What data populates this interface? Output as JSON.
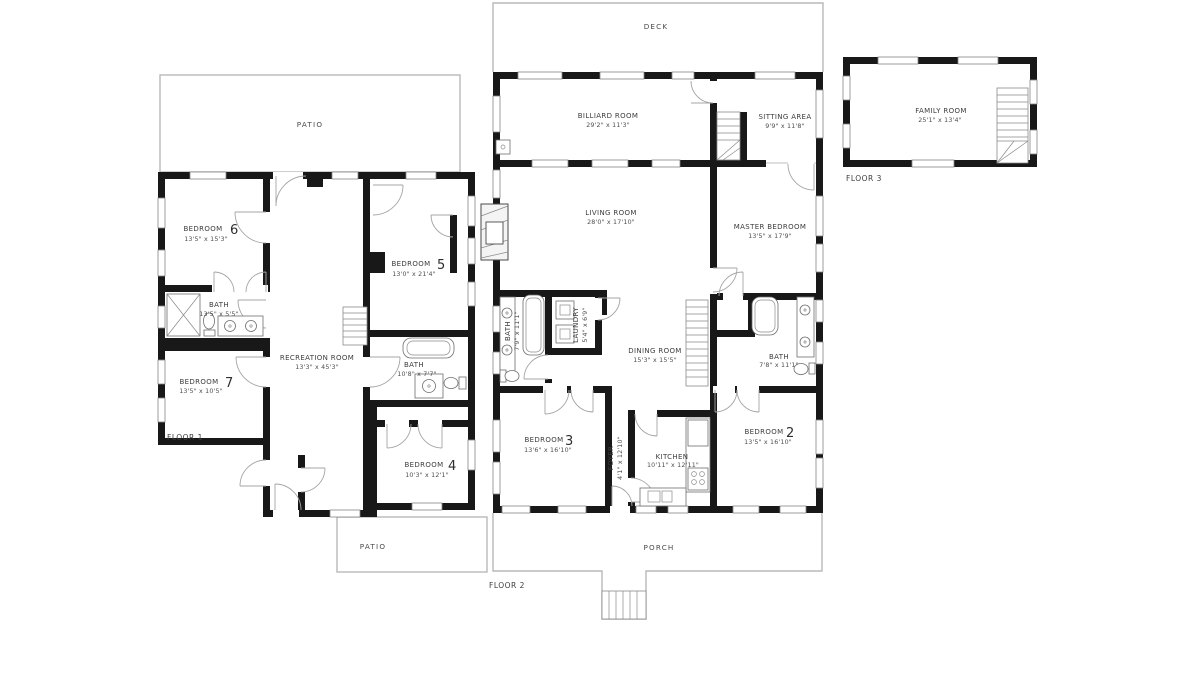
{
  "colors": {
    "wall": "#181818",
    "outline": "#b8b8b8",
    "door_arc": "#a5a5a5",
    "text": "#3c3c3c"
  },
  "floor1": {
    "label": "FLOOR 1",
    "patio_top": "PATIO",
    "patio_bottom": "PATIO",
    "bedroom6": {
      "name": "BEDROOM",
      "number": "6",
      "dims": "13'5\" x 15'3\""
    },
    "bedroom5": {
      "name": "BEDROOM",
      "number": "5",
      "dims": "13'0\" x 21'4\""
    },
    "bath1": {
      "name": "BATH",
      "dims": "13'5\" x 5'5\""
    },
    "recreation": {
      "name": "RECREATION ROOM",
      "dims": "13'3\" x 45'3\""
    },
    "bedroom7": {
      "name": "BEDROOM",
      "number": "7",
      "dims": "13'5\" x 10'5\""
    },
    "bath2": {
      "name": "BATH",
      "dims": "10'8\" x 7'7\""
    },
    "bedroom4": {
      "name": "BEDROOM",
      "number": "4",
      "dims": "10'3\" x 12'1\""
    }
  },
  "floor2": {
    "label": "FLOOR 2",
    "deck": "DECK",
    "porch": "PORCH",
    "billiard": {
      "name": "BILLIARD ROOM",
      "dims": "29'2\" x 11'3\""
    },
    "sitting": {
      "name": "SITTING AREA",
      "dims": "9'9\" x 11'8\""
    },
    "living": {
      "name": "LIVING ROOM",
      "dims": "28'0\" x 17'10\""
    },
    "master": {
      "name": "MASTER BEDROOM",
      "dims": "13'5\" x 17'9\""
    },
    "bath1": {
      "name": "BATH",
      "dims": "7'9\" x 11'1\""
    },
    "laundry": {
      "name": "LAUNDRY",
      "dims": "5'4\" x 6'9\""
    },
    "dining": {
      "name": "DINING ROOM",
      "dims": "15'3\" x 15'5\""
    },
    "bath2": {
      "name": "BATH",
      "dims": "7'8\" x 11'1\""
    },
    "bedroom3": {
      "name": "BEDROOM",
      "number": "3",
      "dims": "13'6\" x 16'10\""
    },
    "foyer": {
      "name": "FOYER",
      "dims": "4'1\" x 12'10\""
    },
    "kitchen": {
      "name": "KITCHEN",
      "dims": "10'11\" x 12'11\""
    },
    "bedroom2": {
      "name": "BEDROOM",
      "number": "2",
      "dims": "13'5\" x 16'10\""
    }
  },
  "floor3": {
    "label": "FLOOR 3",
    "family": {
      "name": "FAMILY ROOM",
      "dims": "25'1\" x 13'4\""
    }
  }
}
